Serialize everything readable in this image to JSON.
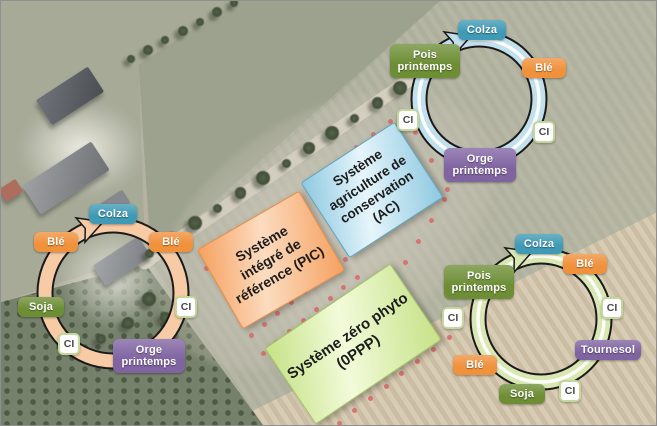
{
  "systems": [
    {
      "name": "pic",
      "label_lines": [
        "Système",
        "intégré de",
        "référence (PIC)"
      ],
      "full_label": "Système intégré de référence (PIC)",
      "fill_light": "#fcdcc0",
      "fill_deep": "#f6a160",
      "border": "#ee8c44",
      "ring_color": "#f6cba6",
      "ring_stripe": false
    },
    {
      "name": "ac",
      "label_lines": [
        "Système",
        "agriculture de",
        "conservation",
        "(AC)"
      ],
      "full_label": "Système agriculture de conservation (AC)",
      "fill_light": "#e6f5fb",
      "fill_deep": "#8ec9e1",
      "border": "#5fa6c3",
      "ring_color": "#c2dfec",
      "ring_stripe": true
    },
    {
      "name": "oppp",
      "label_lines": [
        "Système zéro phyto",
        "(0PPP)"
      ],
      "full_label": "Système zéro phyto (0PPP)",
      "fill_light": "#f2fbda",
      "fill_deep": "#c6e287",
      "border": "#a2c464",
      "ring_color": "#d9e8b3",
      "ring_stripe": true
    }
  ],
  "crop_types": {
    "colza": "#3f9ab6",
    "ble": "#f0913c",
    "legume": "#6d8e35",
    "spring": "#8064a2",
    "ci_border": "#c3d69b",
    "ci_text": "#4a4a4a"
  },
  "cycles": [
    {
      "system": "PIC",
      "items": [
        {
          "label": "Colza",
          "type": "colza"
        },
        {
          "label": "Blé",
          "type": "ble"
        },
        {
          "label": "CI",
          "type": "ci"
        },
        {
          "label": "Orge printemps",
          "type": "spring"
        },
        {
          "label": "CI",
          "type": "ci"
        },
        {
          "label": "Soja",
          "type": "legume"
        },
        {
          "label": "Blé",
          "type": "ble"
        }
      ]
    },
    {
      "system": "AC",
      "items": [
        {
          "label": "Colza",
          "type": "colza"
        },
        {
          "label": "Blé",
          "type": "ble"
        },
        {
          "label": "CI",
          "type": "ci"
        },
        {
          "label": "Orge printemps",
          "type": "spring"
        },
        {
          "label": "CI",
          "type": "ci"
        },
        {
          "label": "Pois printemps",
          "type": "legume"
        }
      ]
    },
    {
      "system": "0PPP",
      "items": [
        {
          "label": "Colza",
          "type": "colza"
        },
        {
          "label": "Blé",
          "type": "ble"
        },
        {
          "label": "CI",
          "type": "ci"
        },
        {
          "label": "Tournesol",
          "type": "spring"
        },
        {
          "label": "CI",
          "type": "ci"
        },
        {
          "label": "Soja",
          "type": "legume"
        },
        {
          "label": "Blé",
          "type": "ble"
        },
        {
          "label": "CI",
          "type": "ci"
        },
        {
          "label": "Pois printemps",
          "type": "legume"
        }
      ]
    }
  ],
  "marker_color": "#d96868"
}
